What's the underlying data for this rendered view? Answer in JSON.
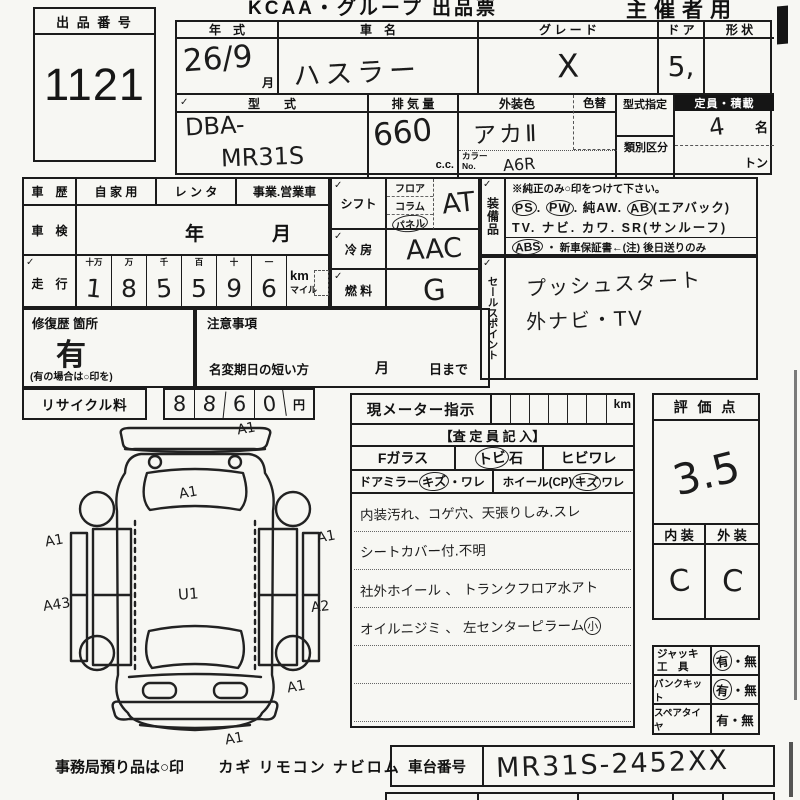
{
  "header": {
    "brand": "KCAA・グループ 出品票",
    "copy_for": "主催者用"
  },
  "tick": "✓",
  "lot": {
    "label": "出 品 番 号",
    "number": "1121"
  },
  "vehicle": {
    "year_label": "年　式",
    "year_value": "26/9",
    "month_suffix": "月",
    "name_label": "車　名",
    "name_value": "ハスラー",
    "grade_label": "グ レ ー ド",
    "grade_value": "X",
    "door_label": "ド ア",
    "door_value": "5,",
    "shape_label": "形 状",
    "model_label": "型　　式",
    "model_prefix": "DBA-",
    "model_code": "MR31S",
    "displacement_label": "排 気 量",
    "displacement_value": "660",
    "displacement_unit": "c.c.",
    "color_label": "外装色",
    "color_value": "アカⅡ",
    "color_change_label": "色替",
    "color_no_label1": "カラー",
    "color_no_label2": "No.",
    "color_no_value": "A6R",
    "type_designation_label": "型式指定",
    "class_division_label": "類別区分",
    "capacity_label": "定員・積載",
    "capacity_value": "4",
    "capacity_unit": "名",
    "load_unit": "トン"
  },
  "history": {
    "label": "車　歴",
    "options": [
      "自 家 用",
      "レ ン タ",
      "事業.営業車"
    ],
    "inspection_label": "車　検",
    "inspection_year": "年",
    "inspection_month": "月",
    "mileage_label": "走　行",
    "digit_headers": [
      "十万",
      "万",
      "千",
      "百",
      "十",
      "一"
    ],
    "digits": [
      "1",
      "8",
      "5",
      "5",
      "9",
      "6"
    ],
    "unit_km": "km",
    "unit_mile": "マイル"
  },
  "repair": {
    "label": "修復歴 箇所",
    "value": "有",
    "note": "(有の場合は○印を)"
  },
  "caution": {
    "label": "注意事項",
    "name_change": "名変期日の短い方",
    "month": "月",
    "until": "日まで"
  },
  "recycle": {
    "label": "リサイクル料",
    "digits": [
      "8",
      "8",
      "6",
      "0"
    ],
    "unit": "円"
  },
  "controls": {
    "shift_label": "シフト",
    "shift_options": [
      "フロア",
      "コラム",
      "パネル"
    ],
    "shift_value": "AT",
    "ac_label": "冷 房",
    "ac_value": "AAC",
    "fuel_label": "燃 料",
    "fuel_value": "G"
  },
  "equipment": {
    "label": "装備品",
    "note": "※純正のみ○印をつけて下さい。",
    "line1": [
      {
        "t": "PS"
      },
      {
        "t": ". "
      },
      {
        "t": "PW"
      },
      {
        "t": ". "
      },
      {
        "t": "純AW. "
      },
      {
        "t": "AB"
      },
      {
        "t": "(エアバック)"
      }
    ],
    "line2": "TV. ナビ. カワ. SR(サンルーフ)",
    "line3_abs": "ABS",
    "line3_rest": "・ 新車保証書←(注) 後日送りのみ",
    "circled_items": [
      "PS",
      "PW",
      "AB",
      "ABS"
    ]
  },
  "sales": {
    "label": "セールスポイント",
    "lines": [
      "プッシュスタート",
      "外ナビ・TV"
    ]
  },
  "meter": {
    "label": "現メーター指示",
    "unit": "km",
    "assessor_header": "【査 定 員 記 入】",
    "glass_label": "Fガラス",
    "stone_label_circled": "トビ",
    "stone_label_rest": "石",
    "crack_label": "ヒビワレ",
    "mirror_label": "ドアミラー ",
    "mirror_kizu": "キズ",
    "mirror_ware": "・ワレ",
    "wheel_label": "ホイール(CP) ",
    "wheel_kizu": "キズ",
    "wheel_ware": " ワレ",
    "notes": [
      "内装汚れ、コゲ穴、天張りしみ.スレ",
      "シートカバー付.不明",
      "社外ホイール 、 トランクフロア水アト",
      "オイルニジミ 、 左センターピラーム"
    ],
    "note4_circled": "小"
  },
  "score": {
    "label": "評 価 点",
    "value": "3.5",
    "interior_label": "内 装",
    "exterior_label": "外 装",
    "interior_value": "C",
    "exterior_value": "C"
  },
  "accessories": {
    "sep": "・",
    "rows": [
      {
        "label1": "ジャッキ",
        "label2": "工　具",
        "yes": "有",
        "no": "無",
        "has": "circled"
      },
      {
        "label1": "パンクキット",
        "label2": "",
        "yes": "有",
        "no": "無",
        "has": "circled"
      },
      {
        "label1": "スペアタイヤ",
        "label2": "",
        "yes": "有",
        "no": "無",
        "has": "none"
      }
    ]
  },
  "chassis": {
    "label": "車台番号",
    "value": "MR31S-2452XX"
  },
  "footer": {
    "office_note": "事務局預り品は○印",
    "items": "カギ リモコン ナビロム"
  },
  "diagram": {
    "marks": [
      "A1",
      "A1",
      "A1",
      "A1",
      "A43",
      "A2",
      "U1",
      "A1",
      "A1"
    ]
  }
}
